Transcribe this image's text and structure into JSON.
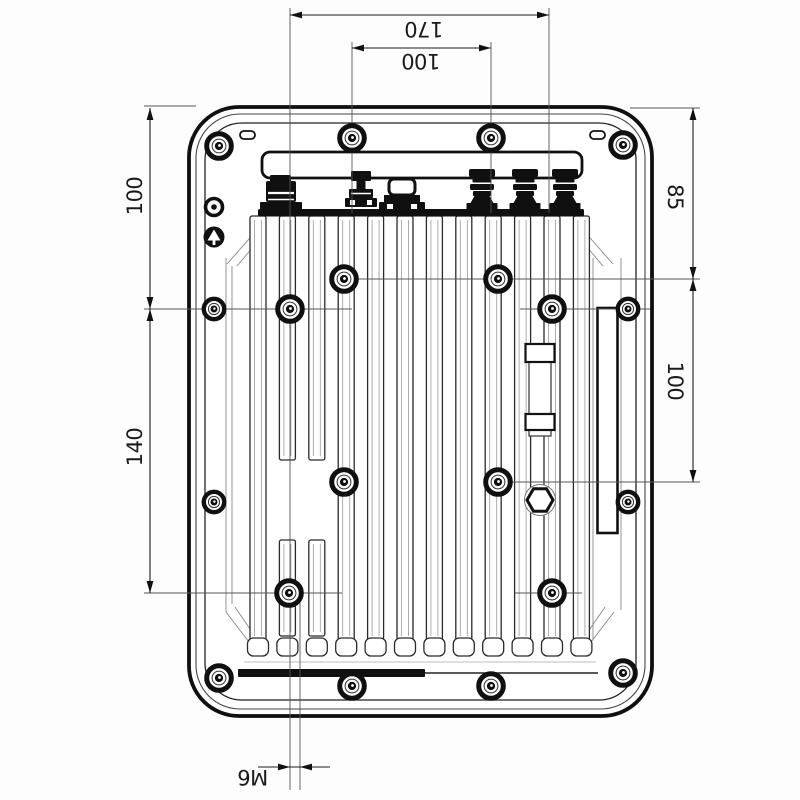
{
  "drawing": {
    "background_color": "#fdfdfd",
    "line_color": "#111111",
    "dimensions": {
      "top_outer": "170",
      "top_inner": "100",
      "left_upper": "100",
      "left_lower": "140",
      "right_upper": "85",
      "right_mid": "100",
      "bottom_thread": "M6"
    },
    "features": {
      "fin_count": 12,
      "connector_count": 6,
      "screw_count": 20,
      "ground_point_count": 2
    }
  }
}
